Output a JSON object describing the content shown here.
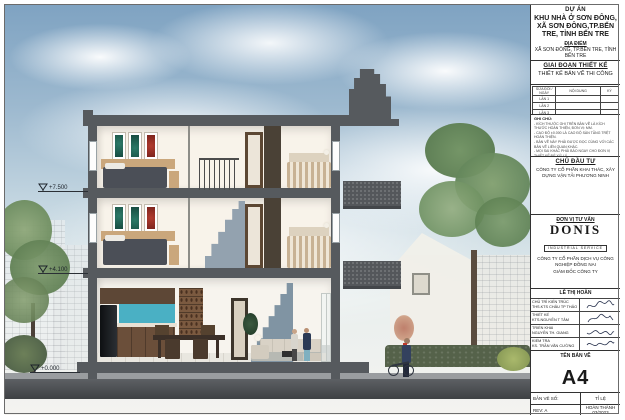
{
  "sheet": {
    "elevation_markers": [
      {
        "label": "+7.500"
      },
      {
        "label": "+4.100"
      },
      {
        "label": "+0.000"
      }
    ]
  },
  "colors": {
    "sky_top": "#7fa3c2",
    "structure_gray": "#565a5e",
    "art_teal": "#2c7a68",
    "art_red": "#b23b2e",
    "stair_blue": "#8094a3",
    "kitchen_backsplash": "#4ab0c4"
  },
  "title_block": {
    "project": {
      "heading": "DỰ ÁN",
      "name": "KHU NHÀ Ở SƠN ĐÔNG, XÃ SƠN ĐÔNG,TP.BẾN TRE, TỈNH BẾN TRE"
    },
    "location": {
      "heading": "ĐỊA ĐIỂM",
      "value": "XÃ SƠN ĐÔNG, TP.BẾN TRE, TỈNH BẾN TRE"
    },
    "phase": {
      "heading": "GIAI ĐOẠN THIẾT KẾ",
      "value": "THIẾT KẾ BẢN VẼ THI CÔNG"
    },
    "revisions": {
      "headers": [
        "SỬA ĐỔI / NGÀY",
        "NỘI DUNG",
        "KÝ"
      ],
      "rows": [
        "LẦN 1",
        "LẦN 2",
        "LẦN 3"
      ]
    },
    "notes": {
      "heading": "GHI CHÚ:",
      "lines": [
        "- KÍCH THƯỚC GHI TRÊN BẢN VẼ LÀ KÍCH THƯỚC HOÀN THIỆN, ĐƠN VỊ: MM.",
        "- CAO ĐỘ ±0.000 LÀ CAO ĐỘ SÀN TẦNG TRỆT HOÀN THIỆN.",
        "- BẢN VẼ NÀY PHẢI ĐƯỢC ĐỌC CÙNG VỚI CÁC BẢN VẼ LIÊN QUAN KHÁC.",
        "- MỌI SAI KHÁC PHẢI BÁO NGAY CHO ĐƠN VỊ THIẾT KẾ ĐỂ XỬ LÝ."
      ],
      "legend_heading": "KÝ HIỆU:",
      "legend_lines": [
        "- CAO ĐỘ HOÀN THIỆN",
        "- CAO ĐỘ KẾT CẤU"
      ]
    },
    "investor": {
      "heading": "CHỦ ĐẦU TƯ",
      "company": "CÔNG TY CỔ PHẦN KHAI THÁC, XÂY DỰNG VẬN TẢI PHƯƠNG NINH"
    },
    "consultant": {
      "heading": "ĐƠN VỊ TƯ VẤN",
      "logo": "DONIS",
      "logo_sub": "INDUSTRIAL SERVICE",
      "company": "CÔNG TY CỔ PHẦN DỊCH VỤ CÔNG NGHIỆP ĐỒNG NAI",
      "director": "GIÁM ĐỐC CÔNG TY"
    },
    "signatures": {
      "name": "LÊ THỊ HOÀN",
      "rows": [
        {
          "role": "CHỦ TRÌ KIẾN TRÚC",
          "person": "THS.KTS CHÂU TP THẢO"
        },
        {
          "role": "THIẾT KẾ",
          "person": "KTS.NGUYỄN T TÂM"
        },
        {
          "role": "TRIỂN KHAI",
          "person": "NGUYỄN TH. GIANG"
        },
        {
          "role": "KIỂM TRA",
          "person": "KS. TRẦN VĂN CƯỜNG"
        }
      ]
    },
    "drawing_name": {
      "heading": "TÊN BẢN VẼ",
      "value": "A4"
    },
    "footer": {
      "sheet_no": "BẢN VẼ SỐ:",
      "scale": "TỈ LỆ",
      "rev": "REV: A",
      "completed": "HOÀN THÀNH 03/2023"
    }
  }
}
